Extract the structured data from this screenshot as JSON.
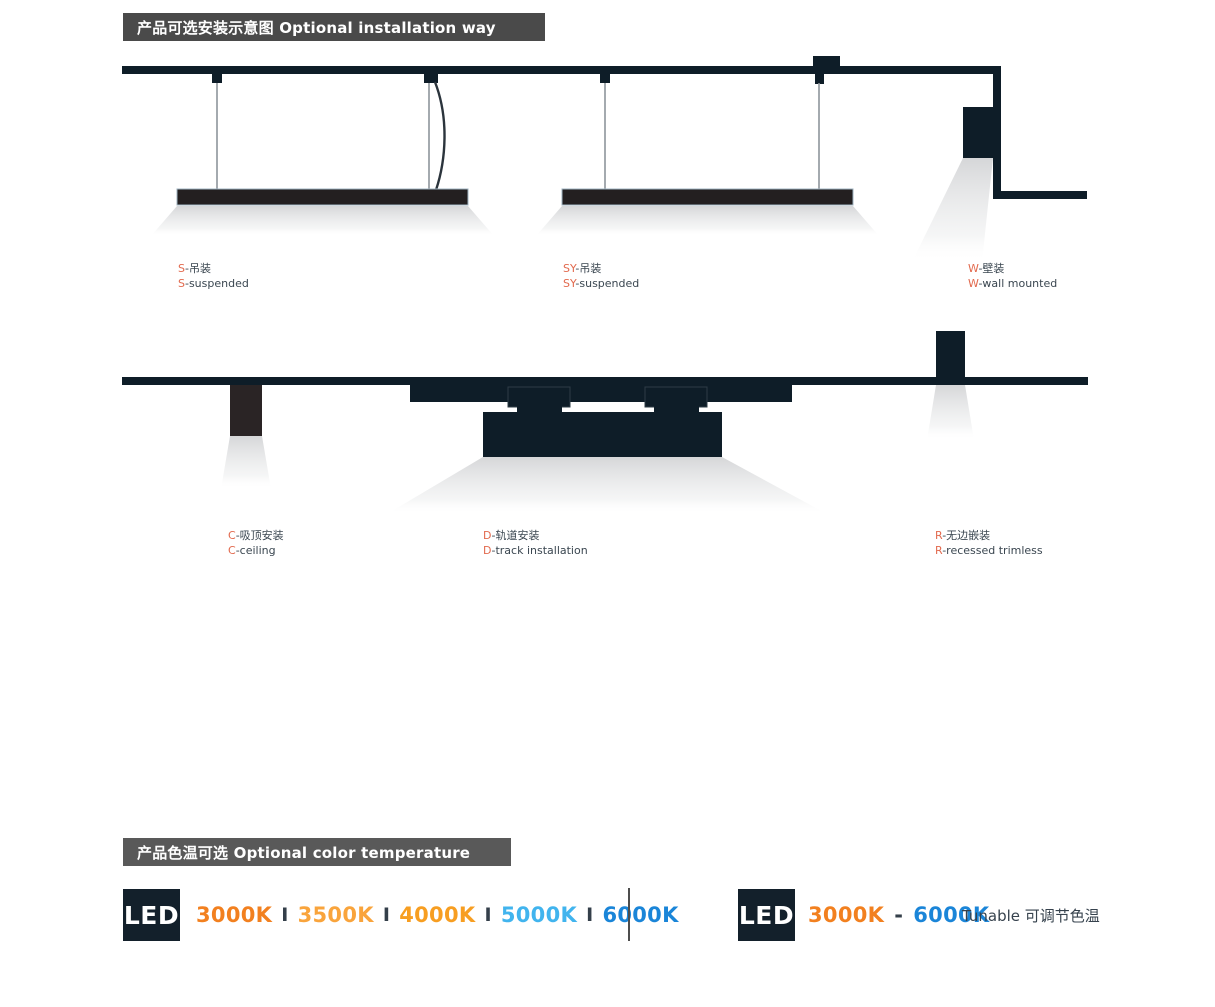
{
  "sections": {
    "installation": {
      "title": "产品可选安装示意图 Optional installation way"
    },
    "color_temperature": {
      "title": "产品色温可选 Optional color temperature"
    }
  },
  "installations": [
    {
      "prefix": "S",
      "zh": "-吊装",
      "en": "-suspended"
    },
    {
      "prefix": "SY",
      "zh": "-吊装",
      "en": "-suspended"
    },
    {
      "prefix": "W",
      "zh": "-壁装",
      "en": "-wall mounted"
    },
    {
      "prefix": "C",
      "zh": "-吸顶安装",
      "en": "-ceiling"
    },
    {
      "prefix": "D",
      "zh": "-轨道安装",
      "en": "-track installation"
    },
    {
      "prefix": "R",
      "zh": "-无边嵌装",
      "en": "-recessed trimless"
    }
  ],
  "led": {
    "badge": "LED",
    "fixed_temps": [
      {
        "label": "3000K",
        "color": "#f2801f"
      },
      {
        "label": "3500K",
        "color": "#f9a43c"
      },
      {
        "label": "4000K",
        "color": "#f79e21"
      },
      {
        "label": "5000K",
        "color": "#41b4ee"
      },
      {
        "label": "6000K",
        "color": "#1a85d8"
      }
    ],
    "separator": "I",
    "separator_color": "#343f4a",
    "tunable": {
      "from": "3000K",
      "from_color": "#f2801f",
      "dash": "-",
      "to": "6000K",
      "to_color": "#1a85d8",
      "note": "Tunable 可调节色温"
    }
  },
  "colors": {
    "diagram_dark": "#0e1d28",
    "lamp_bar_dark": "#231f20",
    "accent": "#e2694d",
    "label_text": "#3a4650",
    "header1_bg": "#4a4a4a",
    "header2_bg": "#595959"
  }
}
